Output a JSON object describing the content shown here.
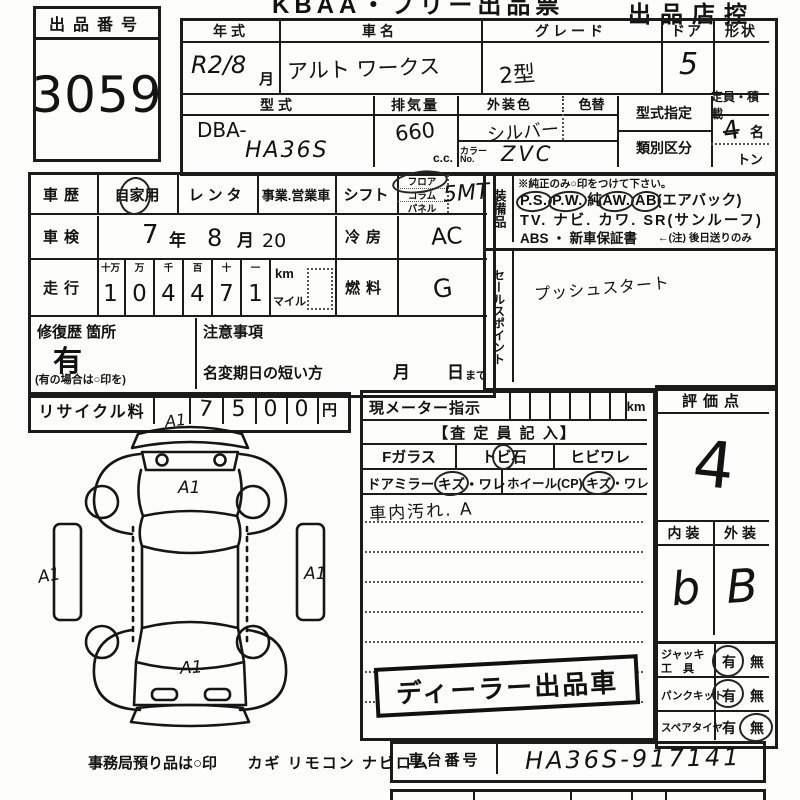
{
  "colors": {
    "paper": "#fdfdfb",
    "ink": "#1b1b1b"
  },
  "header": {
    "title_left": "KBAA・フリー出品票",
    "title_right": "出品店控"
  },
  "auction_no": {
    "label": "出品番号",
    "value": "3059"
  },
  "vehicle": {
    "year": {
      "label": "年式",
      "value": "R2/8",
      "unit": "月"
    },
    "name": {
      "label": "車名",
      "value": "アルト ワークス"
    },
    "grade": {
      "label": "グレード",
      "value": "2型"
    },
    "doors": {
      "label": "ドア",
      "value": "5"
    },
    "shape": {
      "label": "形状",
      "value": ""
    },
    "model": {
      "label": "型式",
      "prefix": "DBA-",
      "value": "HA36S"
    },
    "displacement": {
      "label": "排気量",
      "value": "660",
      "unit": "c.c."
    },
    "ext_color": {
      "label": "外装色",
      "value": "シルバー"
    },
    "color_change": {
      "label": "色替"
    },
    "color_no": {
      "label_1": "カラー",
      "label_2": "No.",
      "value": "ZVC"
    },
    "type_designation": {
      "label": "型式指定",
      "value": ""
    },
    "classification": {
      "label": "類別区分",
      "value": ""
    },
    "capacity": {
      "label": "定員・積載",
      "value": "4",
      "unit": "名",
      "ton": "トン"
    }
  },
  "history": {
    "car_use": {
      "label": "車歴",
      "opt1": "自家用",
      "opt2": "レンタ",
      "opt3": "事業.営業車"
    },
    "inspection": {
      "label": "車検",
      "year": "7",
      "year_unit": "年",
      "month": "8",
      "month_unit": "月",
      "day": "20"
    },
    "mileage": {
      "label": "走行",
      "headers": [
        "十万",
        "万",
        "千",
        "百",
        "十",
        "一"
      ],
      "digits": [
        "1",
        "0",
        "4",
        "4",
        "7",
        "1"
      ],
      "unit1": "km",
      "unit2": "マイル"
    },
    "repair": {
      "label": "修復歴 箇所",
      "value": "有",
      "note": "(有の場合は○印を)"
    },
    "caution": {
      "label": "注意事項"
    },
    "name_change": {
      "label": "名変期日の短い方",
      "month": "月",
      "day": "日",
      "suffix": "まで"
    },
    "recycle": {
      "label": "リサイクル料",
      "digits": [
        "7",
        "5",
        "0",
        "0"
      ],
      "unit": "円"
    }
  },
  "drivetrain": {
    "shift": {
      "label": "シフト",
      "opt1": "フロア",
      "opt2": "コラム",
      "opt3": "パネル",
      "value": "5MT"
    },
    "ac": {
      "label": "冷房",
      "value": "AC"
    },
    "fuel": {
      "label": "燃料",
      "value": "G"
    }
  },
  "equipment": {
    "label": "装備品",
    "note": "※純正のみ○印をつけて下さい。",
    "l1": {
      "t1": "P.S.",
      "t2": "P.W.",
      "t3": "純",
      "t4": "AW.",
      "t5": "AB",
      "t6": "(エアバック)"
    },
    "l2": "TV. ナビ. カワ. SR(サンルーフ)",
    "l3a": "ABS ・ 新車保証書",
    "l3b": "←(注) 後日送りのみ"
  },
  "sales_point": {
    "label": "セールスポイント",
    "value": "プッシュスタート"
  },
  "meter": {
    "label": "現メーター指示",
    "unit": "km"
  },
  "assessor": {
    "header": "【査 定 員 記 入】",
    "fglass": "Fガラス",
    "stone_a": "ト",
    "stone_b": "ビ",
    "stone_c": "石",
    "crack": "ヒビワレ",
    "mirror": "ドアミラー",
    "mirror_kizu": "キズ",
    "mirror_ware": "・ワレ",
    "wheel": "ホイール(CP)",
    "wheel_kizu": "キズ",
    "wheel_ware": "・ワレ",
    "note": "車内汚れ. A"
  },
  "evaluation": {
    "label": "評価点",
    "score": "4",
    "interior_label": "内装",
    "interior": "b",
    "exterior_label": "外装",
    "exterior": "B"
  },
  "tools": {
    "jack": {
      "label1": "ジャッキ",
      "label2": "工　具",
      "yes": "有",
      "no": "無"
    },
    "kit": {
      "label": "パンクキット",
      "yes": "有",
      "no": "無"
    },
    "spare": {
      "label": "スペアタイヤ",
      "yes": "有",
      "no": "無"
    }
  },
  "stamp": {
    "text": "ディーラー出品車"
  },
  "chassis": {
    "label": "車台番号",
    "value": "HA36S-917141"
  },
  "office": {
    "note": "事務局預り品は○印",
    "items": "カギ  リモコン  ナビロム"
  },
  "diagram": {
    "marks": [
      "A1",
      "A1",
      "A1",
      "A1",
      "A1"
    ]
  }
}
